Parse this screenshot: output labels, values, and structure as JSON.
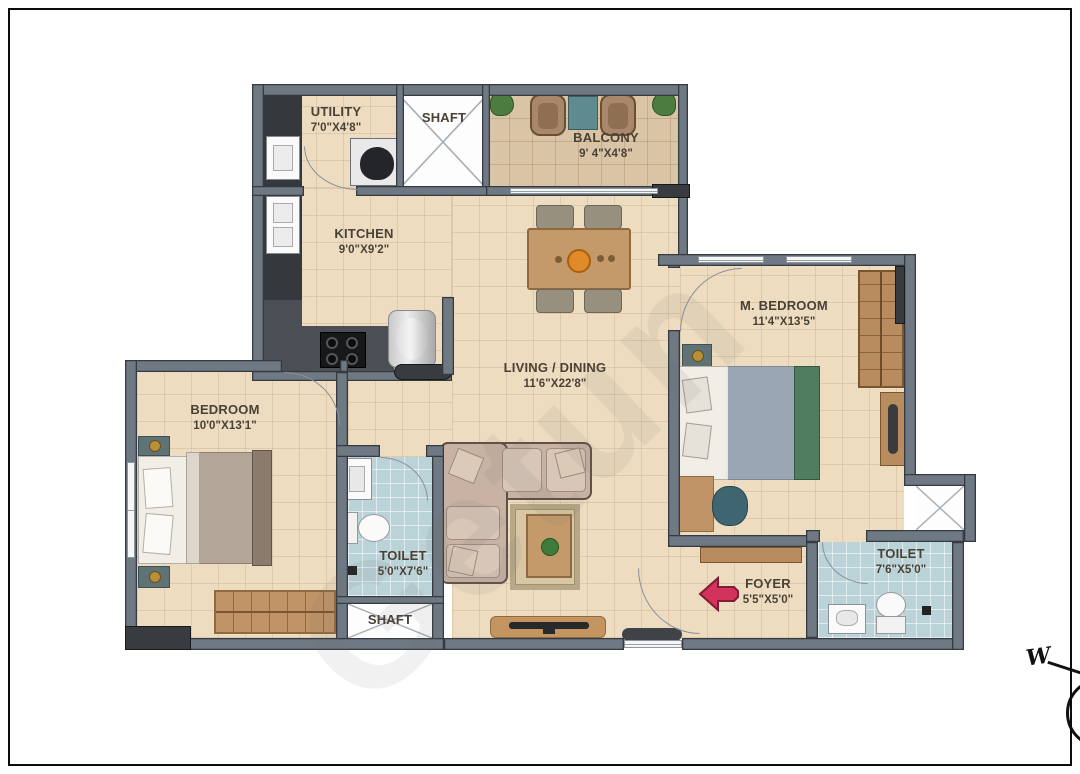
{
  "watermark": "Getun",
  "compass": {
    "west": "W"
  },
  "rooms": {
    "utility": {
      "name": "UTILITY",
      "dims": "7'0\"X4'8\""
    },
    "shaft_top": {
      "name": "SHAFT"
    },
    "balcony": {
      "name": "BALCONY",
      "dims": "9' 4\"X4'8\""
    },
    "kitchen": {
      "name": "KITCHEN",
      "dims": "9'0\"X9'2\""
    },
    "m_bedroom": {
      "name": "M. BEDROOM",
      "dims": "11'4\"X13'5\""
    },
    "living_dining": {
      "name": "LIVING / DINING",
      "dims": "11'6\"X22'8\""
    },
    "bedroom": {
      "name": "BEDROOM",
      "dims": "10'0\"X13'1\""
    },
    "toilet_1": {
      "name": "TOILET",
      "dims": "5'0\"X7'6\""
    },
    "shaft_bottom": {
      "name": "SHAFT"
    },
    "foyer": {
      "name": "FOYER",
      "dims": "5'5\"X5'0\""
    },
    "toilet_2": {
      "name": "TOILET",
      "dims": "7'6\"X5'0\""
    }
  },
  "colors": {
    "floor": "#eddcc0",
    "balcony_floor": "#d9c5a5",
    "toilet_floor": "#b9d3d8",
    "wall": "#6f7983",
    "entry_arrow": "#d1335c",
    "label_text": "#4a4136"
  }
}
